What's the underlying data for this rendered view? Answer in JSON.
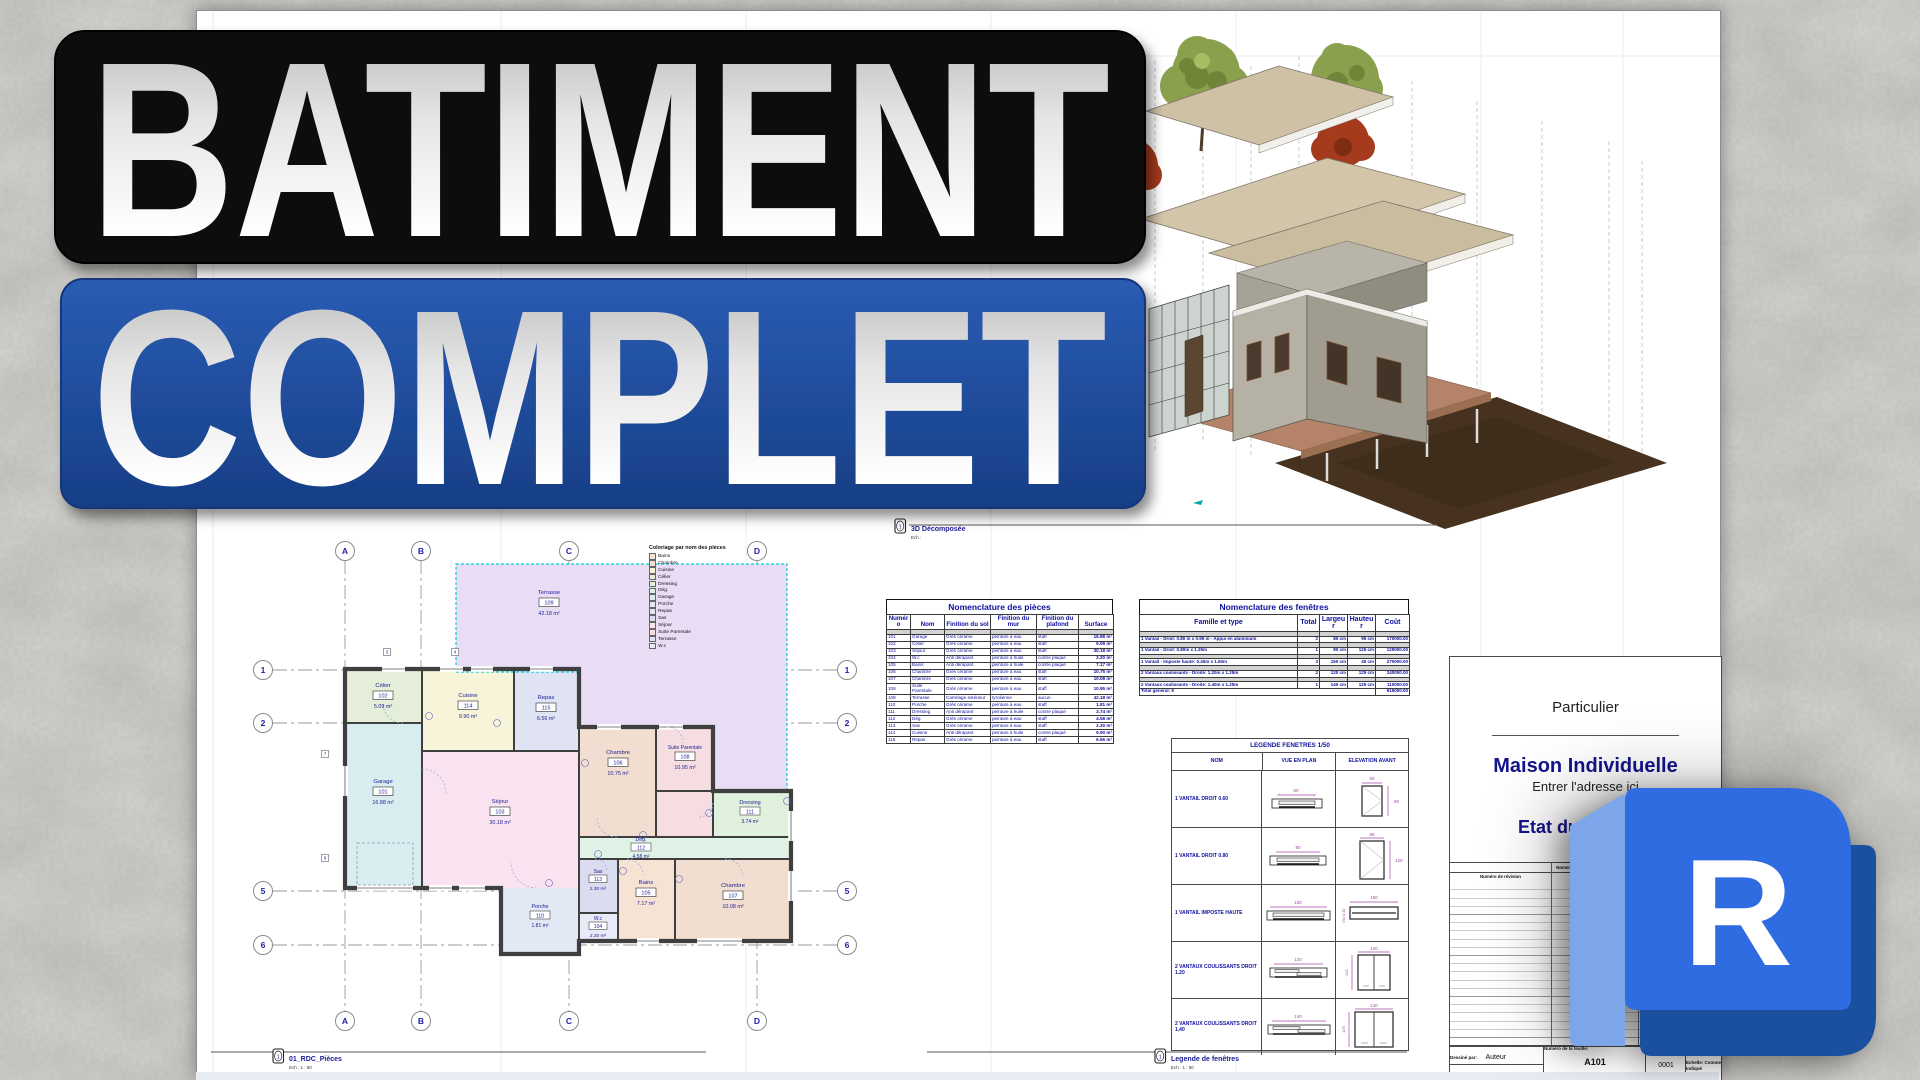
{
  "overlay": {
    "line1": "BATIMENT",
    "line2": "COMPLET",
    "box1_color": "#0c0c0c",
    "box2_color_top": "#2a5cb4",
    "box2_color_bottom": "#173e85"
  },
  "background_color": "#d8d7d3",
  "captions": {
    "plan": {
      "icon": "1",
      "title": "01_RDC_Pièces",
      "scale": "Ech : 1 : 50"
    },
    "d3": {
      "icon": "1",
      "title": "3D Décomposée",
      "scale": "Ech :"
    },
    "legend": {
      "icon": "1",
      "title": "Legende de fenêtres",
      "scale": "Ech : 1 : 50"
    }
  },
  "plan": {
    "grid_cols": [
      "A",
      "B",
      "C",
      "D"
    ],
    "grid_rows": [
      "1",
      "2",
      "5",
      "6"
    ],
    "grid_tags": [
      "3",
      "4",
      "7",
      "9"
    ],
    "rooms": [
      {
        "name": "Garage",
        "num": "101",
        "area": "16.88 m²",
        "color": "#d9edf1"
      },
      {
        "name": "Célier",
        "num": "102",
        "area": "5.09 m²",
        "color": "#e4eed9"
      },
      {
        "name": "Séjour",
        "num": "103",
        "area": "30.18 m²",
        "color": "#f9e3f1"
      },
      {
        "name": "W.c",
        "num": "104",
        "area": "2.20 m²",
        "color": "#e9e9f7"
      },
      {
        "name": "Bains",
        "num": "105",
        "area": "7.17 m²",
        "color": "#f6e3d3"
      },
      {
        "name": "Chambre",
        "num": "106",
        "area": "10.75 m²",
        "color": "#f2ded0"
      },
      {
        "name": "Chambre",
        "num": "107",
        "area": "10.08 m²",
        "color": "#f2ded0"
      },
      {
        "name": "Suite Parentale",
        "num": "108",
        "area": "10.95 m²",
        "color": "#f6dde2"
      },
      {
        "name": "Terrasse",
        "num": "109",
        "area": "42.18 m²",
        "color": "#e8ddf5"
      },
      {
        "name": "Porche",
        "num": "110",
        "area": "1.81 m²",
        "color": "#e2e8f4"
      },
      {
        "name": "Dressing",
        "num": "111",
        "area": "3.74 m²",
        "color": "#dff0dc"
      },
      {
        "name": "Dég.",
        "num": "112",
        "area": "4.58 m²",
        "color": "#e0f2e6"
      },
      {
        "name": "Sas",
        "num": "113",
        "area": "2.30 m²",
        "color": "#dcdcf0"
      },
      {
        "name": "Cuisine",
        "num": "114",
        "area": "9.90 m²",
        "color": "#f8f4d9"
      },
      {
        "name": "Repas",
        "num": "115",
        "area": "6.56 m²",
        "color": "#dfe3f3"
      }
    ],
    "coloriage": {
      "title": "Coloriage par nom des pièces",
      "items": [
        {
          "label": "Bains",
          "color": "#f6e3d3"
        },
        {
          "label": "Chambre",
          "color": "#f2ded0"
        },
        {
          "label": "Cuisine",
          "color": "#f8f4d9"
        },
        {
          "label": "Célier",
          "color": "#e4eed9"
        },
        {
          "label": "Dressing",
          "color": "#dff0dc"
        },
        {
          "label": "Dég.",
          "color": "#e0f2e6"
        },
        {
          "label": "Garage",
          "color": "#d9edf1"
        },
        {
          "label": "Porche",
          "color": "#e2e8f4"
        },
        {
          "label": "Repas",
          "color": "#dfe3f3"
        },
        {
          "label": "Sas",
          "color": "#dcdcf0"
        },
        {
          "label": "Séjour",
          "color": "#f9e3f1"
        },
        {
          "label": "Suite Parentale",
          "color": "#f6dde2"
        },
        {
          "label": "Terrasse",
          "color": "#e8ddf5"
        },
        {
          "label": "W.c",
          "color": "#e9e9f7"
        }
      ]
    }
  },
  "tables": {
    "pieces": {
      "title": "Nomenclature des pièces",
      "headers": [
        "Numéro",
        "Nom",
        "Finition du sol",
        "Finition du mur",
        "Finition du plafond",
        "Surface"
      ],
      "rows": [
        [
          "101",
          "Garage",
          "Grès cérame",
          "peinture à eau",
          "staff",
          "16.88 m²"
        ],
        [
          "102",
          "Célier",
          "Grès cérame",
          "peinture à eau",
          "staff",
          "5.09 m²"
        ],
        [
          "103",
          "Séjour",
          "Grès cérame",
          "peinture à eau",
          "staff",
          "30.18 m²"
        ],
        [
          "104",
          "W.c",
          "Anti dérapant",
          "peinture à huile",
          "contre plaqué",
          "2.20 m²"
        ],
        [
          "105",
          "Bains",
          "Anti dérapant",
          "peinture à huile",
          "contre plaqué",
          "7.17 m²"
        ],
        [
          "106",
          "Chambre",
          "Grès cérame",
          "peinture à eau",
          "staff",
          "10.75 m²"
        ],
        [
          "107",
          "Chambre",
          "Grès cérame",
          "peinture à eau",
          "staff",
          "10.08 m²"
        ],
        [
          "108",
          "Suite Parentale",
          "Grès cérame",
          "peinture à eau",
          "staff",
          "10.95 m²"
        ],
        [
          "109",
          "Terrasse",
          "Carrelage extérieur",
          "tyrolienne",
          "aucun",
          "42.18 m²"
        ],
        [
          "110",
          "Porche",
          "Grès cérame",
          "peinture à eau",
          "staff",
          "1.81 m²"
        ],
        [
          "111",
          "Dressing",
          "Anti dérapant",
          "peinture à huile",
          "contre plaqué",
          "3.74 m²"
        ],
        [
          "112",
          "Dég.",
          "Grès cérame",
          "peinture à eau",
          "staff",
          "4.58 m²"
        ],
        [
          "113",
          "Sas",
          "Grès cérame",
          "peinture à eau",
          "staff",
          "2.30 m²"
        ],
        [
          "114",
          "Cuisine",
          "Anti dérapant",
          "peinture à huile",
          "contre plaqué",
          "9.90 m²"
        ],
        [
          "115",
          "Repas",
          "Grès cérame",
          "peinture à eau",
          "staff",
          "6.56 m²"
        ]
      ]
    },
    "fenetres": {
      "title": "Nomenclature des fenêtres",
      "headers": [
        "Famille et type",
        "Total",
        "Largeur",
        "Hauteur",
        "Coût"
      ],
      "rows": [
        [
          "1 Vantail - Droit: 0.80 m x 0.95 m - Appui en aluminium",
          "2",
          "80 cm",
          "95 cm",
          "170000.00"
        ],
        [
          "1 Vantail - Droit: 0.80m x 1.25m",
          "1",
          "80 cm",
          "125 cm",
          "125000.00"
        ],
        [
          "1 Vantail - Imposte haute: 0.40m x 1.50m",
          "3",
          "150 cm",
          "40 cm",
          "270000.00"
        ],
        [
          "2 Vantaux coulissants - Droite: 1.20m x 1.25m",
          "2",
          "120 cm",
          "125 cm",
          "240000.00"
        ],
        [
          "2 Vantaux coulissants - Droite: 1.40m x 1.25m",
          "1",
          "140 cm",
          "125 cm",
          "110000.00"
        ]
      ],
      "total_label": "Total général: 9",
      "total_value": "915000.00"
    },
    "legende_fenetres": {
      "title": "LEGENDE FENETRES 1/50",
      "headers": [
        "NOM",
        "VUE EN PLAN",
        "ELEVATION AVANT"
      ],
      "rows": [
        {
          "name": "1 VANTAIL DROIT 0.60",
          "plan_w": "60",
          "elev_w": "60",
          "elev_h": "90"
        },
        {
          "name": "1 VANTAIL DROIT 0.80",
          "plan_w": "80",
          "elev_w": "80",
          "elev_h": "120"
        },
        {
          "name": "1 VANTAIL IMPOSTE HAUTE",
          "plan_w": "150",
          "elev_w": "150",
          "elev_h": "Vsl 0.40"
        },
        {
          "name": "2 VANTAUX COULISSANTS DROIT 1.20",
          "plan_w": "120",
          "elev_w": "120",
          "elev_h": "125"
        },
        {
          "name": "2 VANTAUX COULISSANTS DROIT 1.40",
          "plan_w": "140",
          "elev_w": "140",
          "elev_h": "125"
        }
      ]
    }
  },
  "titleblock": {
    "client": "Particulier",
    "project": "Maison Individuelle",
    "address": "Entrer l'adresse ici",
    "status": "Etat du",
    "revision_header": "Nomenclature des révisions",
    "rev_col1": "Numéro de révision",
    "rev_col2": "Date de révision",
    "drawn_label": "Dessiné par:",
    "drawn_value": "Auteur",
    "approved_label": "Approuvé par:",
    "approved_value": "Approbateur",
    "sheet_no_label": "Numéro de la feuille:",
    "sheet_no": "A101",
    "doc_no": "0001",
    "scale_label": "Echelle: Comme Indiqué"
  },
  "revit_logo": {
    "letter": "R",
    "front_color": "#2f6ce2",
    "side_color": "#7da5ea",
    "back_color": "#1b4fa0"
  }
}
